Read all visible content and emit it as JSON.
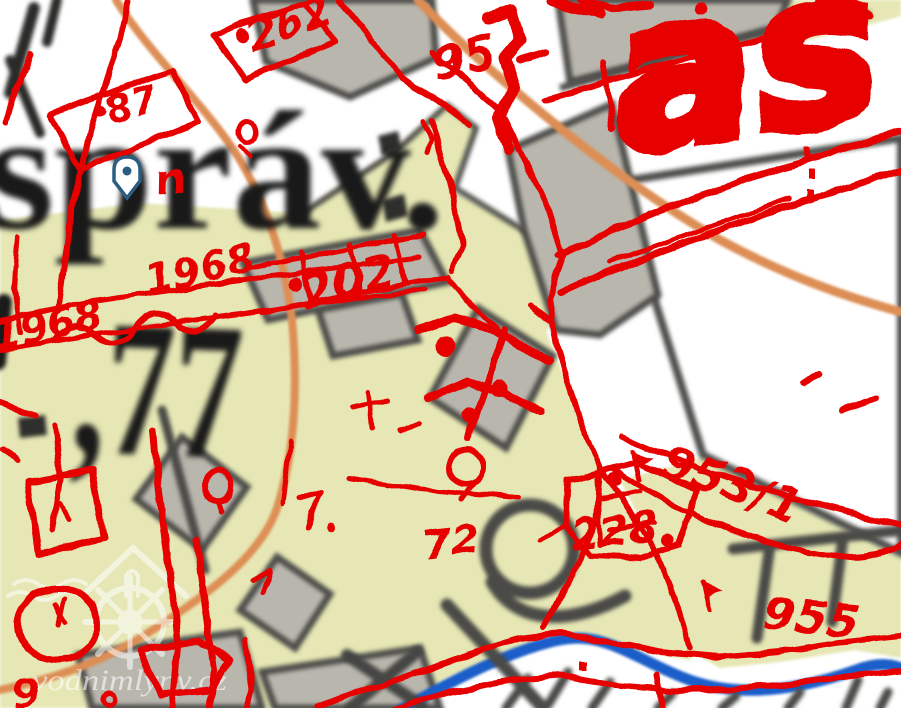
{
  "map_canvas": {
    "base_labels": {
      "sprav": "správ.",
      "n77": ",77"
    },
    "red_labels": {
      "n262": "262",
      "n87": "87",
      "n95": "95",
      "n1968a": "1968",
      "n1968b": "1968",
      "n202": "202",
      "big_script": "as",
      "n953_1": "953/1",
      "n955": "955",
      "n228": "228",
      "n72": "72",
      "squiggle_n": "n",
      "n9": "9"
    },
    "watermark": {
      "text": "vodnimlyny.cz"
    },
    "icons": {
      "marker": "location-pin",
      "watermark": "watermill-icon"
    },
    "colors": {
      "overlay_red": "#e60000",
      "parcel_fill": "#e6e7b4",
      "building_fill": "#b9b6ad",
      "building_outline": "#4d4d4a",
      "road_orange": "#dd8e55",
      "river_blue": "#1b5ec9",
      "base_text": "#1a1a1a",
      "marker_blue": "#2b5d80"
    }
  }
}
